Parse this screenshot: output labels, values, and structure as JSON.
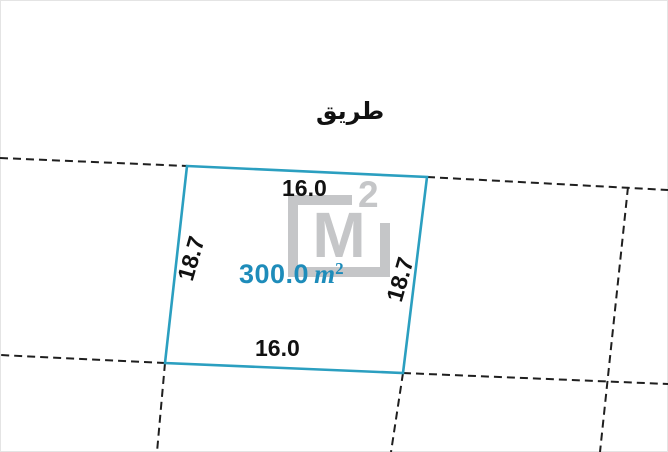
{
  "diagram": {
    "road_label": "طريق",
    "plot": {
      "area_value": "300.0",
      "area_unit": "m",
      "area_exponent": "2",
      "top_dim": "16.0",
      "bottom_dim": "16.0",
      "left_dim": "18.7",
      "right_dim": "18.7"
    },
    "watermark": {
      "letter": "M",
      "exponent": "2"
    },
    "colors": {
      "plot_stroke": "#2b9fc0",
      "area_text": "#1e8cba",
      "boundary_dash": "#1f1f1f",
      "watermark_gray": "#c5c6c8"
    }
  }
}
